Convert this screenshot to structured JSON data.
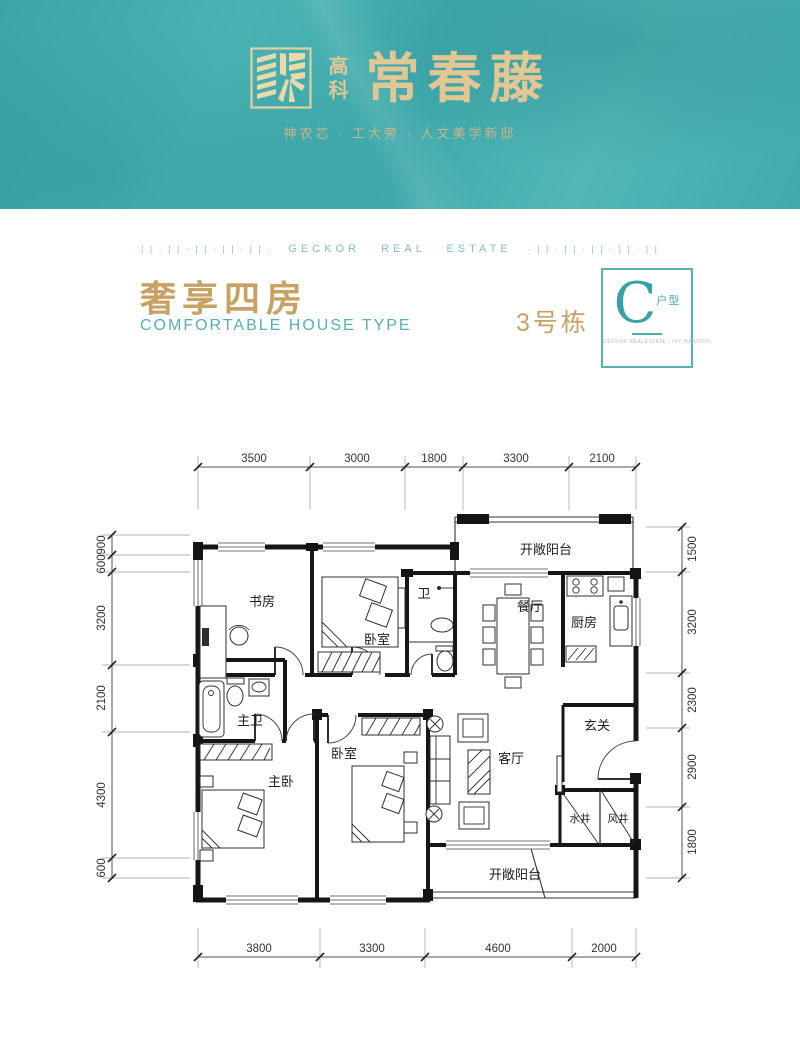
{
  "header": {
    "logo_top": "高",
    "logo_bottom": "科",
    "brand": "常春藤",
    "tagline": "神农芯 · 工大旁 · 人文美学新邸"
  },
  "divider": {
    "left_pattern": "| | · | | · | | · | | · | | ·",
    "label": "GECKOR REAL ESTATE",
    "right_pattern": "· | | · | | · | | · | | · | |"
  },
  "title": {
    "cn": "奢享四房",
    "en": "COMFORTABLE HOUSE TYPE",
    "building": "3号栋"
  },
  "badge": {
    "letter": "C",
    "suffix": "户型",
    "caption_left": "GECKOR REALESTATE",
    "caption_right": "IVY MANSION"
  },
  "floorplan": {
    "rooms": {
      "study": "书房",
      "bedroom_top": "卧室",
      "bath": "卫",
      "dining": "餐厅",
      "kitchen": "厨房",
      "balcony_top": "开敞阳台",
      "master_bath": "主卫",
      "bedroom_mid": "卧室",
      "master_bedroom": "主卧",
      "foyer": "玄关",
      "living": "客厅",
      "water_shaft": "水井",
      "air_shaft": "风井",
      "balcony_bottom": "开敞阳台"
    },
    "dims_top": [
      "3500",
      "3000",
      "1800",
      "3300",
      "2100"
    ],
    "dims_bottom": [
      "3800",
      "3300",
      "4600",
      "2000"
    ],
    "dims_left": [
      "900",
      "600",
      "3200",
      "2100",
      "4300",
      "600"
    ],
    "dims_right": [
      "1500",
      "3200",
      "2300",
      "2900",
      "1800"
    ]
  },
  "colors": {
    "teal": "#42abad",
    "gold": "#c8a262",
    "logo_gold": "#dcc290"
  }
}
